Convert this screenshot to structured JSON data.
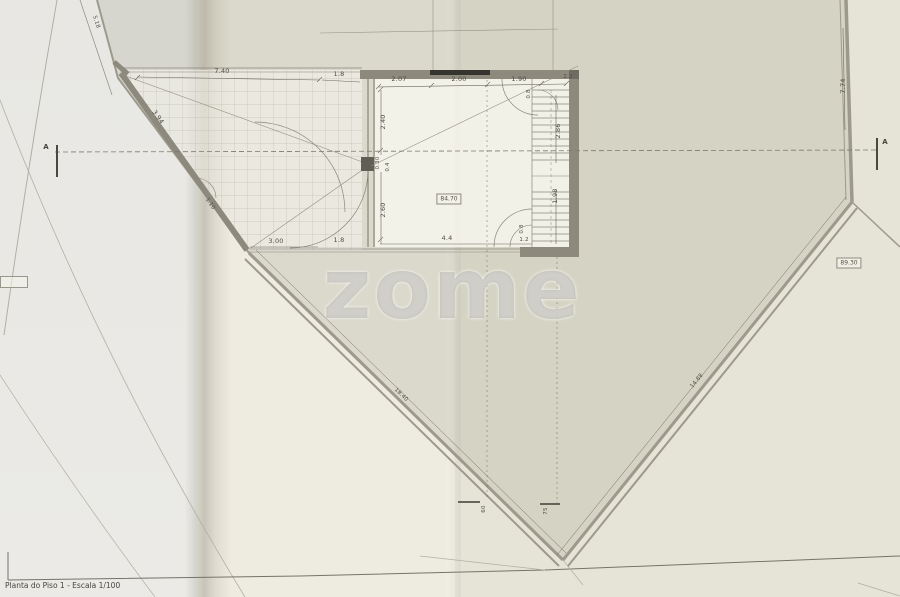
{
  "document": {
    "title": "Planta do Piso 1 - Escala 1/100"
  },
  "watermark": {
    "text": "zome"
  },
  "section": {
    "left_label": "A",
    "right_label": "A"
  },
  "levels": {
    "room_area": "84.70",
    "level_right": "89.30",
    "level_left_partial": ""
  },
  "dims": {
    "terrace_width": "7.40",
    "terrace_opening_top": "1.8",
    "room_top_1": "2.07",
    "room_top_2": "2.00",
    "room_top_3": "1.90",
    "room_top_4": "2.2",
    "divider_upper": "2.40",
    "column_w": "0.30",
    "column_d": "0.4",
    "divider_lower": "2.60",
    "terrace_opening_bottom": "1.8",
    "terrace_bottom": "3.00",
    "room_bottom": "4.4",
    "room_bottom_small": "1.2",
    "terrace_diagonal": "3.94",
    "terrace_small": "1.10",
    "topleft_boundary": "5.18",
    "right_boundary": "7.74",
    "stairs_upper": "2.86",
    "stairs_lower": "1.98",
    "door_top": "0.8",
    "door_bottom": "0.8",
    "parcel_edge_left": "18.40",
    "parcel_edge_right": "14.88",
    "level_tick_1": "60",
    "level_tick_2": "75"
  },
  "colors": {
    "paper": "#eceadf",
    "parcel_fill": "#d4d2c4",
    "wall": "#8d897d",
    "boundary": "#9d998c",
    "line": "#6b685e",
    "watermark_gray": "#acaaa0"
  }
}
